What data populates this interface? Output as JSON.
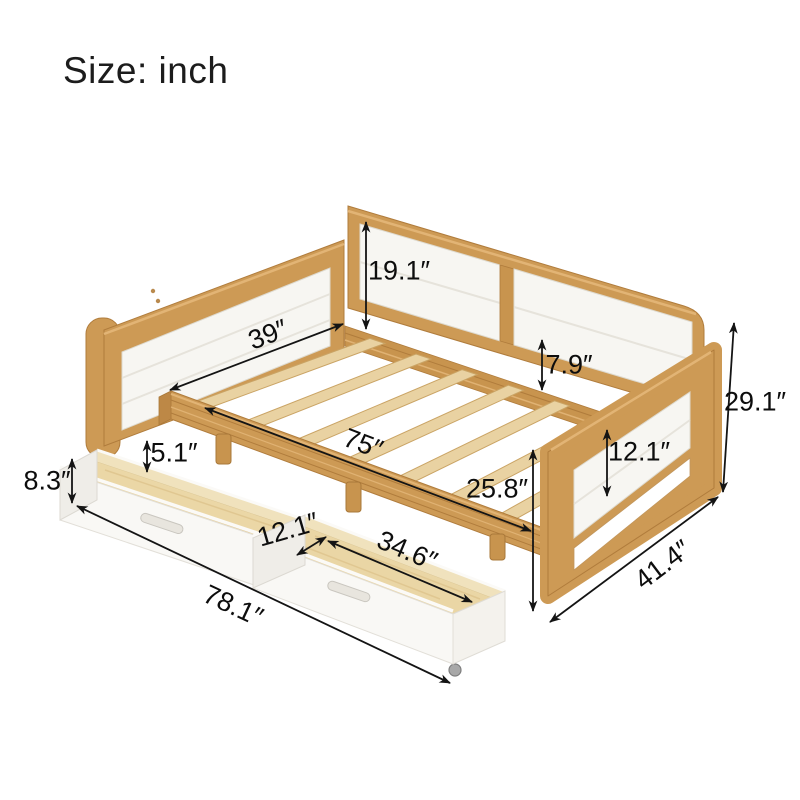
{
  "page": {
    "title": "Size: inch"
  },
  "colors": {
    "wood_frame": "#cd9a55",
    "wood_dark": "#b07c3c",
    "wood_light": "#e2b475",
    "slat_wood": "#e9d2a2",
    "panel_white": "#f7f6f2",
    "drawer_interior": "#ebd7a6",
    "annotation": "#141414"
  },
  "measurements": {
    "backrest_panel_height": "19.1″",
    "bed_inner_width": "39″",
    "rail_to_slat_gap": "7.9″",
    "overall_height": "29.1″",
    "slat_area_length": "75″",
    "drawer_inner_height": "5.1″",
    "drawer_outer_height": "8.3″",
    "arm_panel_height": "12.1″",
    "frame_side_height": "25.8″",
    "drawer_width": "12.1″",
    "drawer_length": "34.6″",
    "overall_depth": "41.4″",
    "overall_length": "78.1″"
  }
}
